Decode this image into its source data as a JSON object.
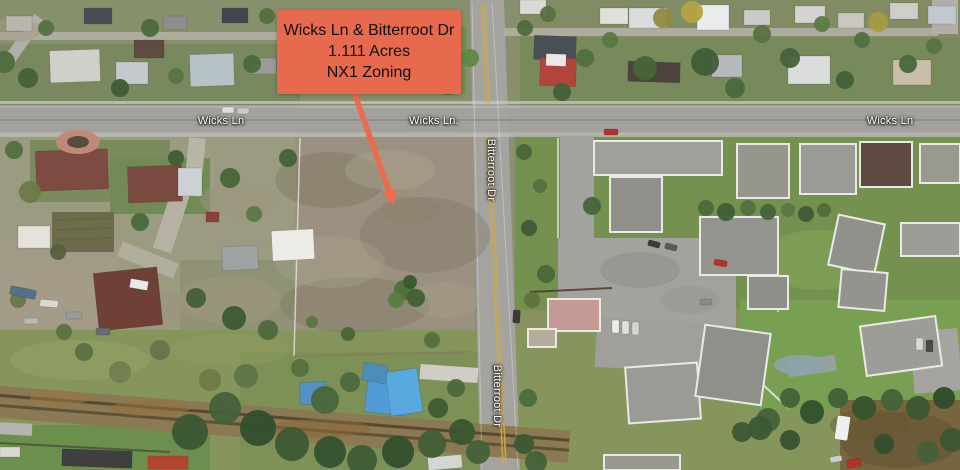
{
  "street_labels": {
    "wicks_left": "Wicks Ln",
    "wicks_center": "Wicks Ln.",
    "wicks_right": "Wicks Ln",
    "bitterroot_upper": "Bitterroot Dr",
    "bitterroot_lower": "Bitterroot Dr"
  },
  "annotation": {
    "line1": "Wicks Ln & Bitterroot Dr",
    "line2": "1.111 Acres",
    "line3": "NX1 Zoning",
    "box_color": "#e7694e",
    "arrow_color": "#ed6a4c",
    "text_color": "#111111"
  }
}
